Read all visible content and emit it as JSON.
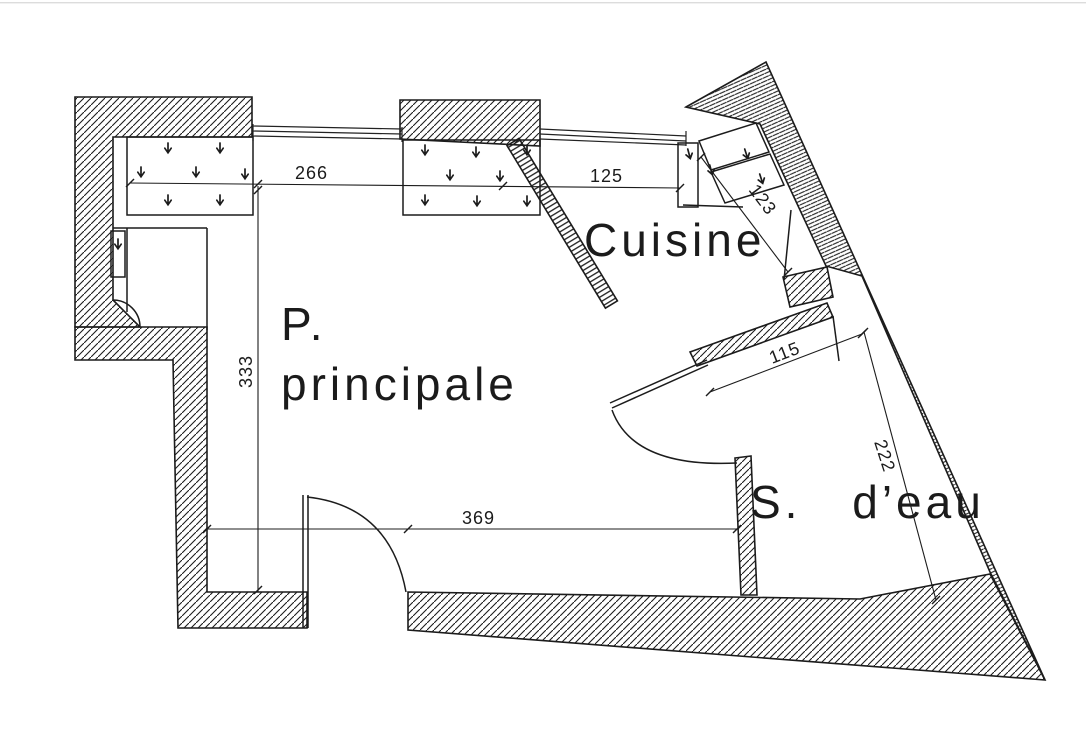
{
  "page": {
    "background": "#ffffff",
    "ink": "#1c1c1c",
    "drawing_type": "floor plan"
  },
  "rooms": {
    "main_line1": "P.",
    "main_line2": "principale",
    "kitchen": "Cuisine",
    "bathroom": "S. d’eau"
  },
  "dimensions": {
    "top_window": "266",
    "kitchen_window": "125",
    "left_height": "333",
    "bottom_width": "369",
    "bath_passage": "115",
    "kitchen_wall": "123",
    "bath_wall": "222"
  }
}
